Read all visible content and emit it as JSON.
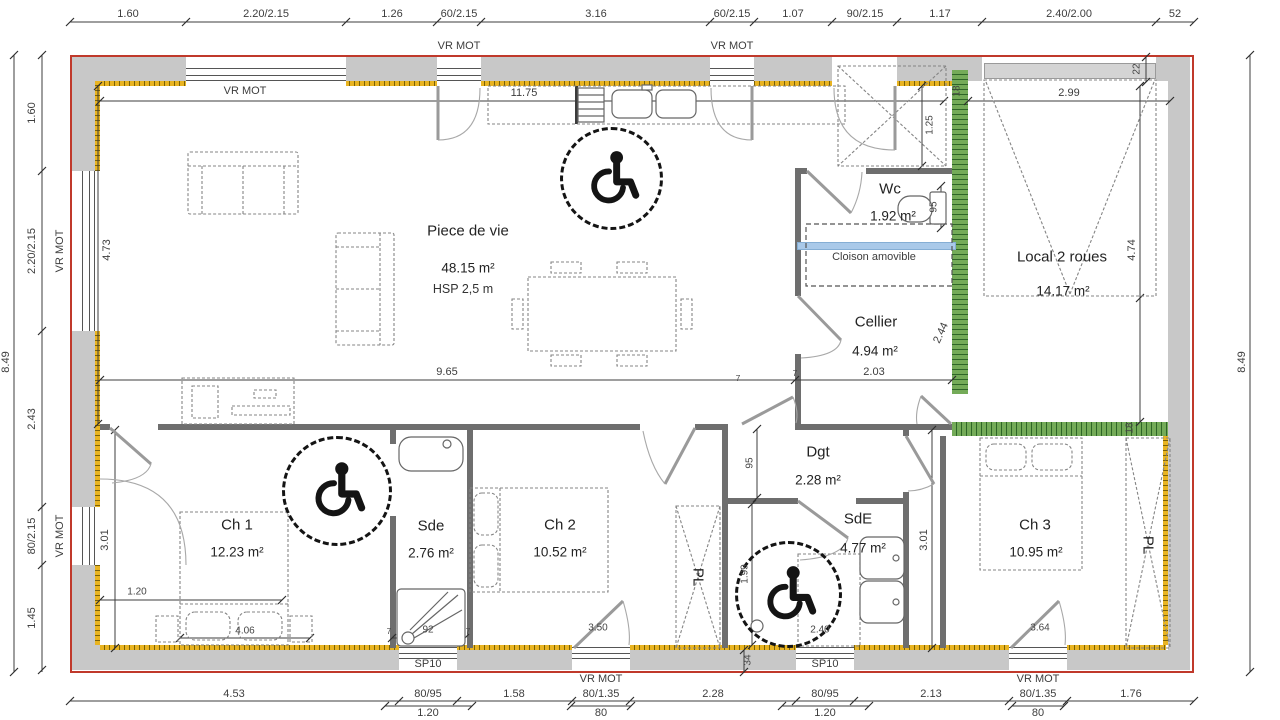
{
  "plan": {
    "rooms": {
      "piece_de_vie": {
        "name": "Piece de vie",
        "area": "48.15 m²",
        "hsp": "HSP 2,5 m"
      },
      "wc": {
        "name": "Wc",
        "area": "1.92 m²"
      },
      "cellier": {
        "name": "Cellier",
        "area": "4.94 m²"
      },
      "local_2_roues": {
        "name": "Local 2 roues",
        "area": "14.17 m²"
      },
      "dgt": {
        "name": "Dgt",
        "area": "2.28 m²"
      },
      "ch1": {
        "name": "Ch 1",
        "area": "12.23 m²"
      },
      "sde": {
        "name": "Sde",
        "area": "2.76 m²"
      },
      "ch2": {
        "name": "Ch 2",
        "area": "10.52 m²"
      },
      "sde2": {
        "name": "SdE",
        "area": "4.77 m²"
      },
      "ch3": {
        "name": "Ch 3",
        "area": "10.95 m²"
      },
      "pl1": "PL",
      "pl2": "PL",
      "cloison": "Cloison amovible"
    },
    "window_labels": {
      "vr_mot": "VR MOT",
      "sp10": "SP10"
    },
    "dims": {
      "top": [
        "1.60",
        "2.20/2.15",
        "1.26",
        "60/2.15",
        "3.16",
        "60/2.15",
        "1.07",
        "90/2.15",
        "1.17",
        "2.40/2.00",
        "52"
      ],
      "bottom": [
        "4.53",
        "80/95",
        "1.58",
        "80/1.35",
        "2.28",
        "80/95",
        "2.13",
        "80/1.35",
        "1.76"
      ],
      "bottom_sub": [
        "1.20",
        "80",
        "1.20",
        "80"
      ],
      "left": [
        "1.60",
        "2.20/2.15",
        "2.43",
        "80/2.15",
        "1.45"
      ],
      "overall_left": "8.49",
      "overall_right": "8.49",
      "interior": {
        "kitchen": "11.75",
        "living_w": "9.65",
        "living_h": "4.73",
        "garage_w": "2.99",
        "garage_h": "4.74",
        "garage_lintel": "22",
        "wall18_a": "18",
        "wall18_b": "18",
        "closet": "1.25",
        "cellier_w": "2.03",
        "cellier_door": "2.44",
        "wc_side": "95",
        "dgt_w": "95",
        "wall7_a": "7",
        "wall7_b": "7",
        "ch1_h": "3.01",
        "ch1_off": "1.20",
        "ch1_bed": "4.06",
        "shower": "92",
        "shower_wall_l": "7",
        "shower_wall_r": "7",
        "ch2_w": "3.50",
        "sde2_h": "1.99",
        "sde2_w": "2.40",
        "sde2_wall": "34",
        "ch3_h": "3.01",
        "ch3_w": "3.64"
      }
    },
    "colors": {
      "exterior_line": "#c0392b",
      "wall_fill": "#c8c8c8",
      "insulation_yellow": "#e9b421",
      "green_wall": "#74ab58",
      "cloison_blue": "#a9c9e9",
      "symbol_black": "#141414"
    }
  }
}
